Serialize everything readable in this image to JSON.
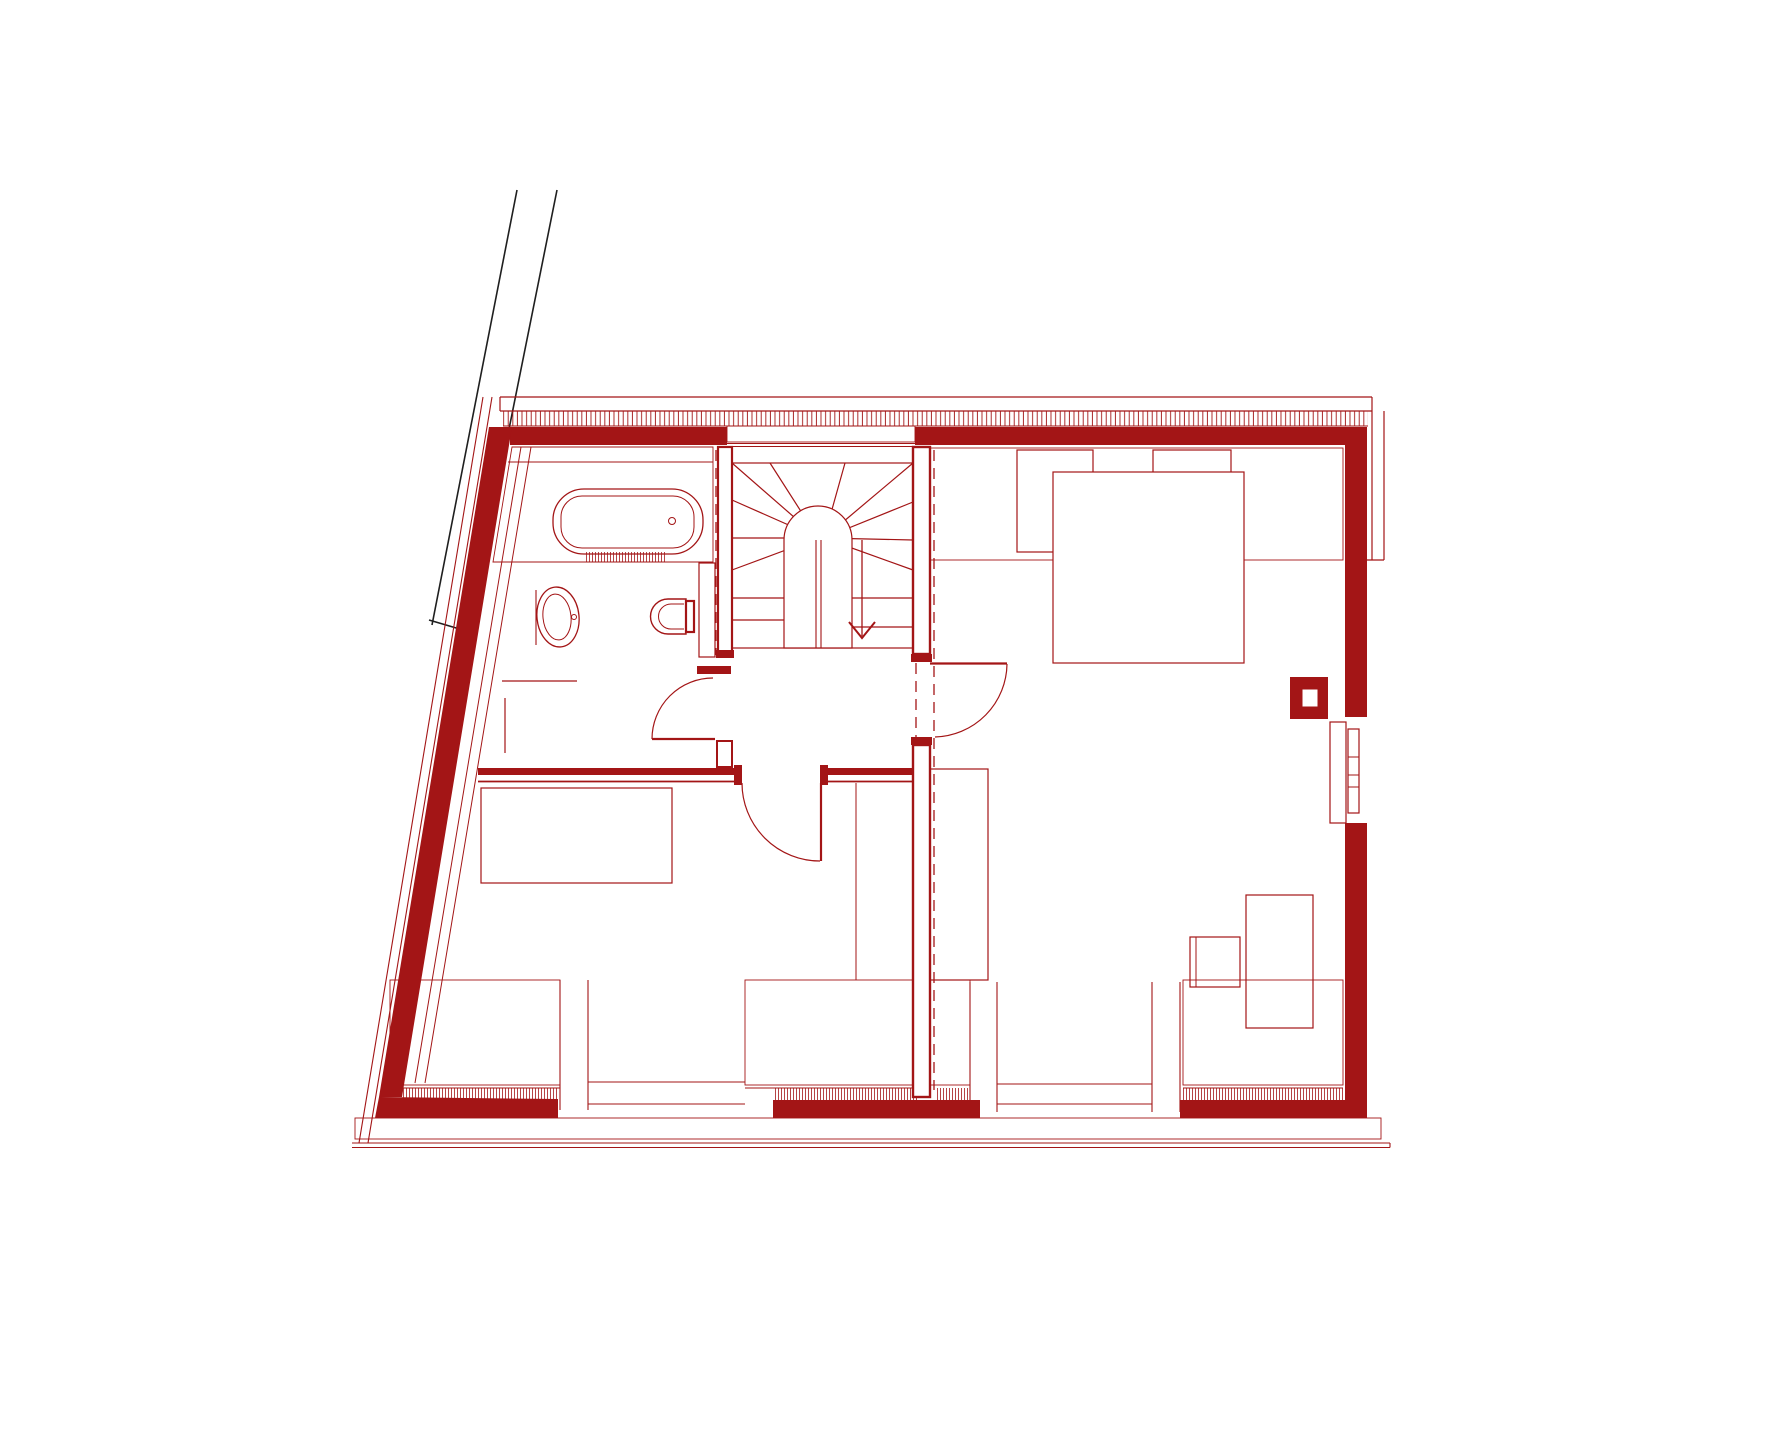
{
  "document": {
    "kind": "architectural-floor-plan",
    "description": "Upper (attic) floor plan drawn in dark red line work on white; no text labels visible",
    "visible_text": []
  },
  "colors": {
    "red": "#A31516",
    "black": "#1F1F1F",
    "bg": "#FFFFFF"
  },
  "plan": {
    "rooms": [
      "bathroom-top-left",
      "winder-stair-hall-center",
      "bedroom-bottom-left",
      "bedroom-right"
    ],
    "fixtures": [
      "bathtub",
      "towel-radiator",
      "washbasin",
      "toilet",
      "winder-stair",
      "stair-direction-arrow"
    ],
    "furniture": [
      "bed-right",
      "bed-bottom-left",
      "wardrobe-right-room",
      "cabinet-small",
      "cabinet-tall"
    ],
    "building_elements": [
      "sloped-roof-hatch-bands",
      "roof-window-1",
      "roof-window-2",
      "chimney",
      "facade-window-bay-left",
      "facade-window-bay-center",
      "facade-window-bay-small",
      "facade-window-bay-right",
      "glass-front-left",
      "glass-front-right",
      "side-window-right-wall",
      "roof-overhang-outline",
      "neighbor-boundary-lines",
      "section-dash-lines",
      "doors"
    ],
    "door_count": 3,
    "roof_window_count": 2,
    "window_bay_count": 4
  }
}
